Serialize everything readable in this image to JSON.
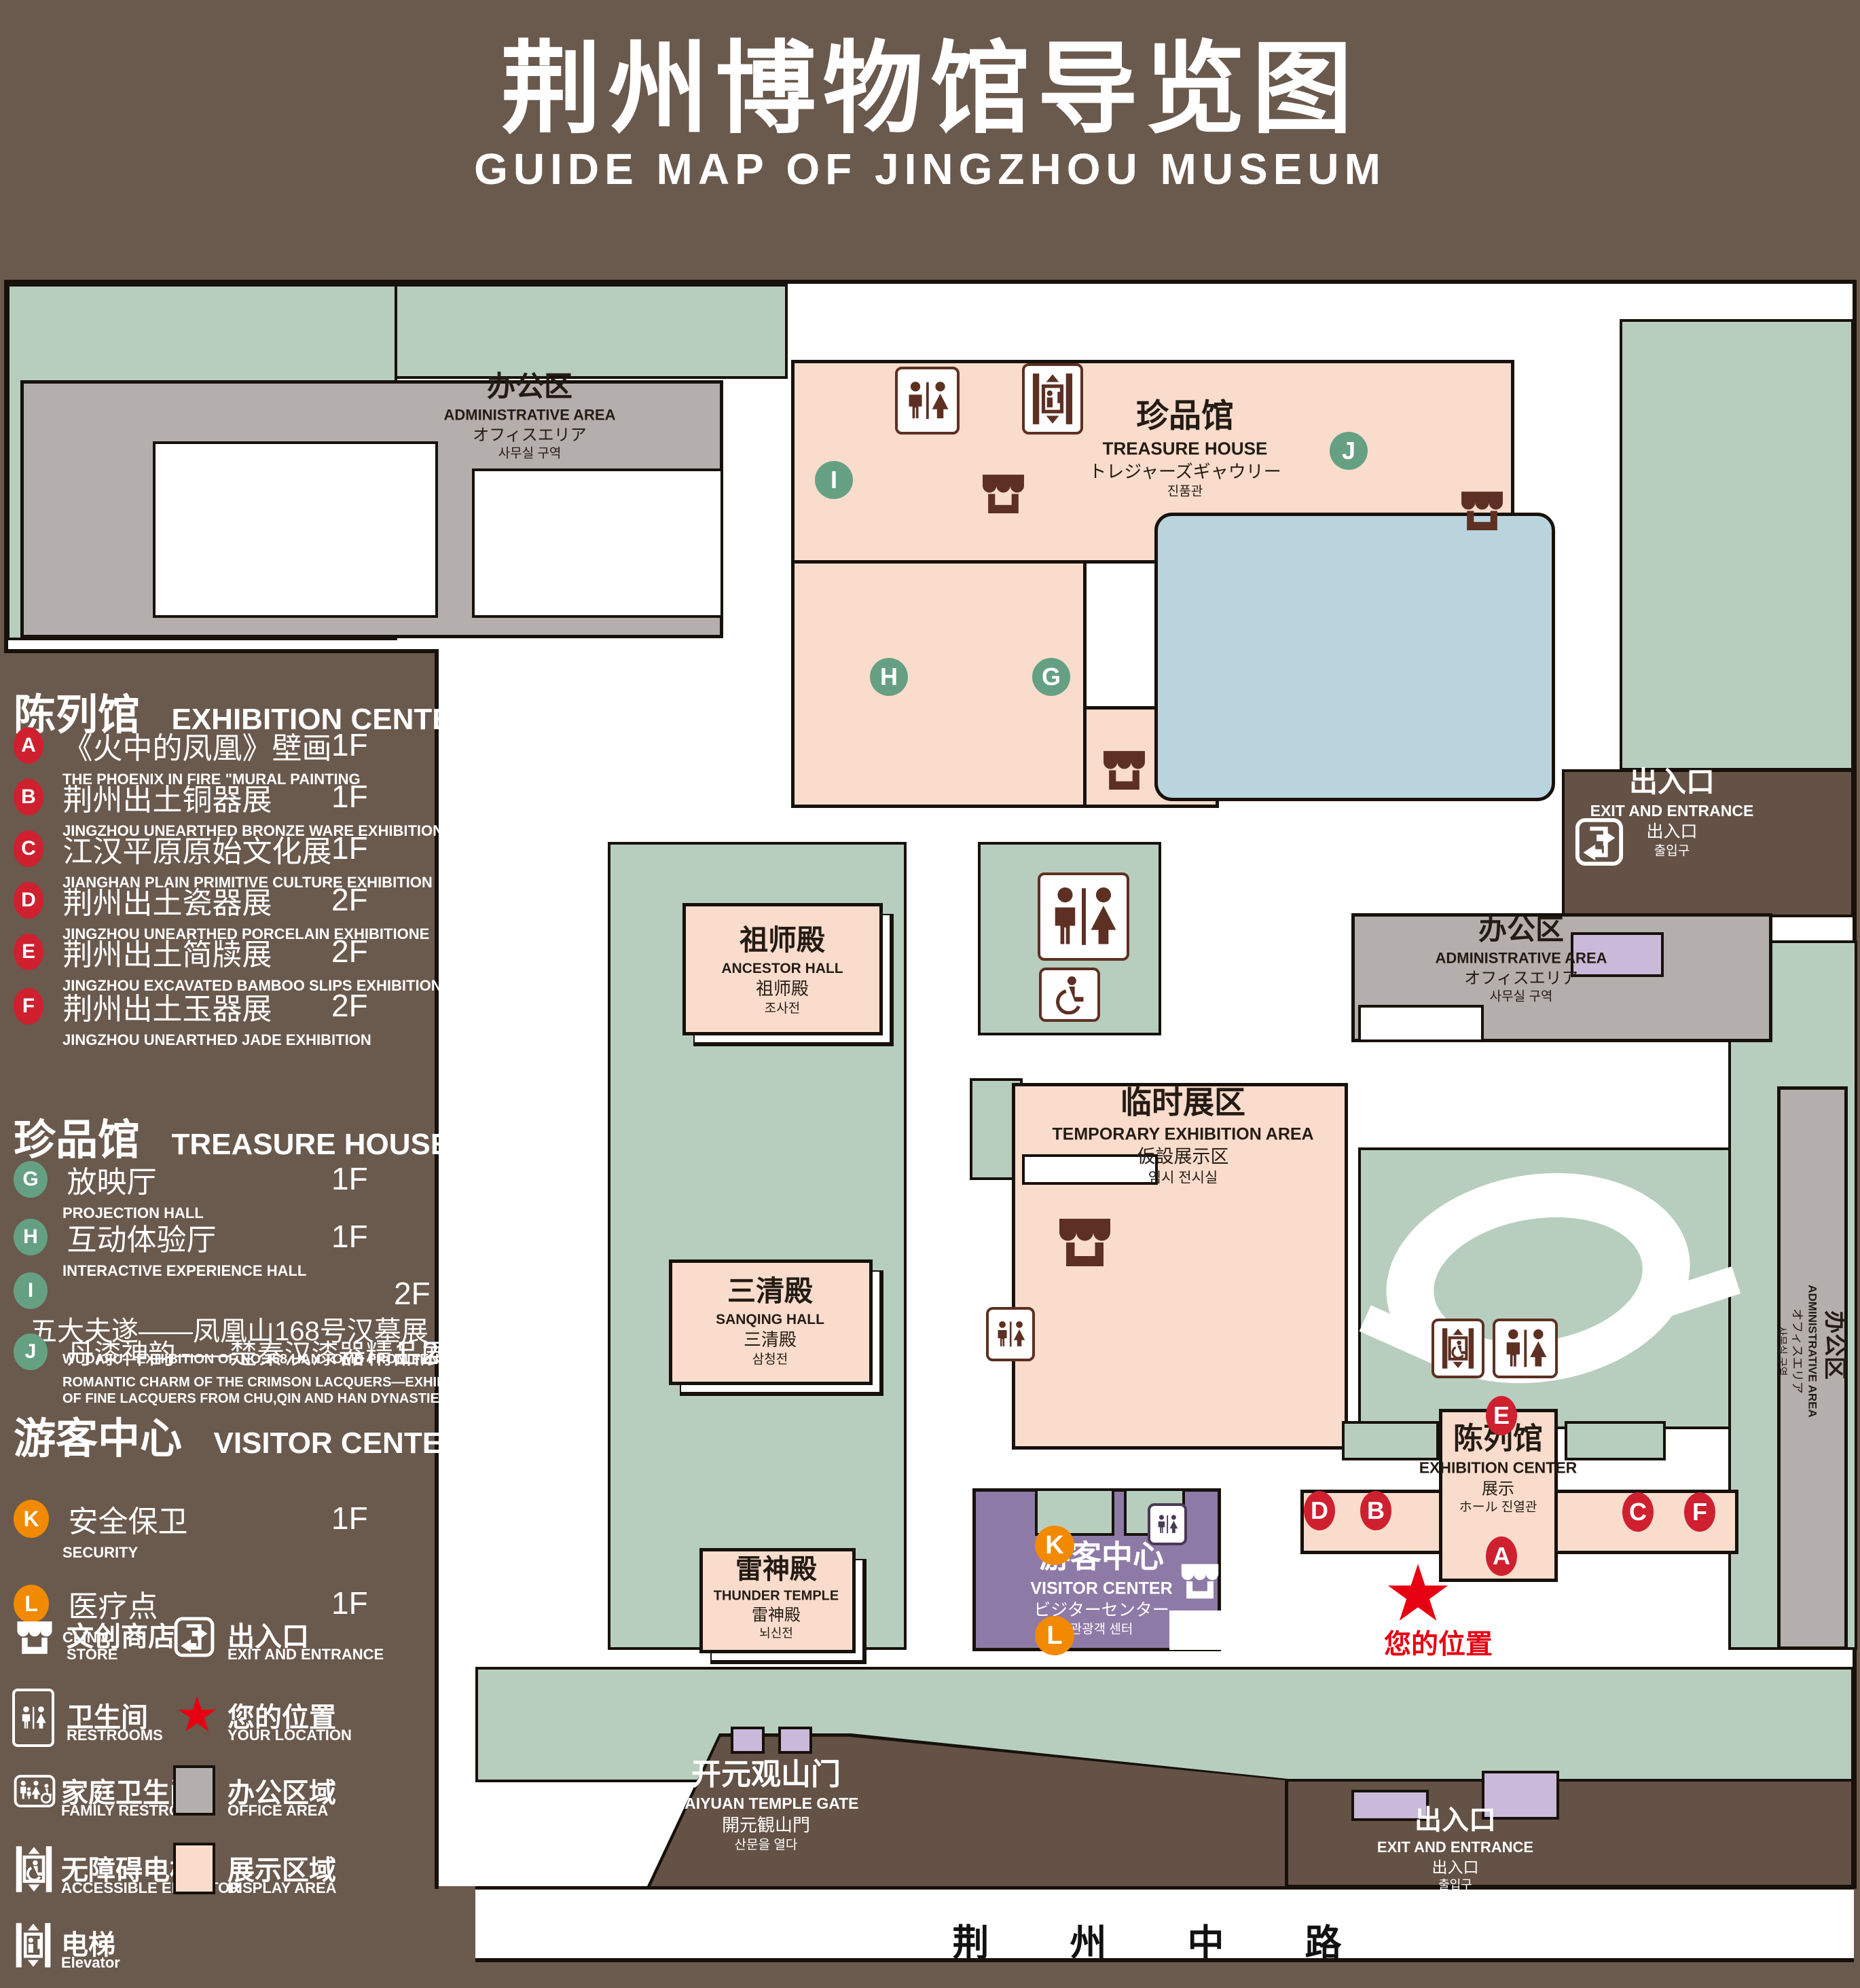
{
  "title": {
    "zh": "荆州博物馆导览图",
    "en": "GUIDE MAP OF JINGZHOU MUSEUM"
  },
  "colors": {
    "background": "#6a594d",
    "map_green": "#b7cebe",
    "display_area": "#f9dccc",
    "office_area": "#b4afac",
    "visitor_center": "#8e7aa7",
    "pond": "#bad4dd",
    "marker_red": "#cf2030",
    "marker_green": "#66a083",
    "marker_orange": "#f18a00",
    "location_red": "#e60012",
    "icon_brown": "#5d3023"
  },
  "legend": {
    "sections": [
      {
        "zh": "陈列馆",
        "en": "EXHIBITION CENTER",
        "items": [
          {
            "letter": "A",
            "zh": "《火中的凤凰》壁画",
            "en": "THE PHOENIX IN FIRE \"MURAL PAINTING",
            "floor": "1F"
          },
          {
            "letter": "B",
            "zh": "荆州出土铜器展",
            "en": "JINGZHOU UNEARTHED BRONZE WARE EXHIBITION",
            "floor": "1F"
          },
          {
            "letter": "C",
            "zh": "江汉平原原始文化展",
            "en": "JIANGHAN PLAIN PRIMITIVE CULTURE EXHIBITION",
            "floor": "1F"
          },
          {
            "letter": "D",
            "zh": "荆州出土瓷器展",
            "en": "JINGZHOU UNEARTHED PORCELAIN EXHIBITIONE",
            "floor": "2F"
          },
          {
            "letter": "E",
            "zh": "荆州出土简牍展",
            "en": "JINGZHOU EXCAVATED BAMBOO SLIPS EXHIBITION",
            "floor": "2F"
          },
          {
            "letter": "F",
            "zh": "荆州出土玉器展",
            "en": "JINGZHOU UNEARTHED JADE EXHIBITION",
            "floor": "2F"
          }
        ]
      },
      {
        "zh": "珍品馆",
        "en": "TREASURE HOUSE",
        "items": [
          {
            "letter": "G",
            "zh": "放映厅",
            "en": "PROJECTION HALL",
            "floor": "1F"
          },
          {
            "letter": "H",
            "zh": "互动体验厅",
            "en": "INTERACTIVE EXPERIENCE HALL",
            "floor": "1F"
          },
          {
            "letter": "I",
            "zh": "五大夫遂——凤凰山168号汉墓展",
            "en": "WUDAFU—EXHIBITION OF NO.168 HAN TOMB FROM FENGHUANGSHAN",
            "floor": "2F"
          },
          {
            "letter": "J",
            "zh": "丹漆神韵——楚秦汉漆器精品展",
            "en": "ROMANTIC CHARM OF THE CRIMSON LACQUERS—EXHIBITIONS",
            "en2": "OF FINE LACQUERS FROM CHU,QIN AND HAN DYNASTIES",
            "floor": "1-2F"
          }
        ]
      },
      {
        "zh": "游客中心",
        "en": "VISITOR CENTER",
        "items": [
          {
            "letter": "K",
            "zh": "安全保卫",
            "en": "SECURITY",
            "floor": "1F"
          },
          {
            "letter": "L",
            "zh": "医疗点",
            "en": "CLINIC",
            "floor": "1F"
          }
        ]
      }
    ],
    "symbols": [
      {
        "icon": "store-icon",
        "zh": "文创商店",
        "en": "STORE"
      },
      {
        "icon": "exit-entrance-icon",
        "zh": "出入口",
        "en": "EXIT AND ENTRANCE"
      },
      {
        "icon": "restrooms-icon",
        "zh": "卫生间",
        "en": "RESTROOMS"
      },
      {
        "icon": "your-location-star",
        "zh": "您的位置",
        "en": "YOUR LOCATION"
      },
      {
        "icon": "family-restrooms-icon",
        "zh": "家庭卫生间",
        "en": "FAMILY RESTROOMS"
      },
      {
        "icon": "office-area-swatch",
        "zh": "办公区域",
        "en": "OFFICE AREA"
      },
      {
        "icon": "accessible-elevator-icon",
        "zh": "无障碍电梯",
        "en": "ACCESSIBLE ELEVATOR"
      },
      {
        "icon": "display-area-swatch",
        "zh": "展示区域",
        "en": "DISPLAY AREA"
      },
      {
        "icon": "elevator-icon",
        "zh": "电梯",
        "en": "Elevator"
      }
    ]
  },
  "map": {
    "buildings": {
      "admin_top_left": {
        "zh": "办公区",
        "en": "ADMINISTRATIVE AREA",
        "jp": "オフィスエリア",
        "kr": "사무실 구역"
      },
      "treasure_house": {
        "zh": "珍品馆",
        "en": "TREASURE HOUSE",
        "jp": "トレジャーズギャウリー",
        "kr": "진품관"
      },
      "ancestor_hall": {
        "zh": "祖师殿",
        "en": "ANCESTOR HALL",
        "zh2": "祖师殿",
        "kr": "조사전"
      },
      "admin_right": {
        "zh": "办公区",
        "en": "ADMINISTRATIVE AREA",
        "jp": "オフィスエリア",
        "kr": "사무실 구역"
      },
      "admin_right_strip": {
        "zh": "办公区",
        "en": "ADMINISTRATIVE AREA",
        "jp": "オフィスエリア",
        "kr": "사무실 구역"
      },
      "temporary_exhibition": {
        "zh": "临时展区",
        "en": "TEMPORARY EXHIBITION AREA",
        "jp": "仮設展示区",
        "kr": "임시 전시실"
      },
      "sanqing_hall": {
        "zh": "三清殿",
        "en": "SANQING HALL",
        "zh2": "三清殿",
        "kr": "삼청전"
      },
      "thunder_temple": {
        "zh": "雷神殿",
        "en": "THUNDER TEMPLE",
        "zh2": "雷神殿",
        "kr": "뇌신전"
      },
      "visitor_center": {
        "zh": "游客中心",
        "en": "VISITOR CENTER",
        "jp": "ビジターセンター",
        "kr": "관광객 센터"
      },
      "exhibition_center": {
        "zh": "陈列馆",
        "en": "EXHIBITION CENTER",
        "jp": "展示",
        "kr": "ホール 진열관"
      },
      "kaiyuan_gate": {
        "zh": "开元观山门",
        "en": "KAIYUAN TEMPLE GATE",
        "jp": "開元観山門",
        "kr": "산문을 열다"
      },
      "exit_right": {
        "zh": "出入口",
        "en": "EXIT AND ENTRANCE",
        "zh2": "出入口",
        "kr": "출입구"
      },
      "exit_bottom": {
        "zh": "出入口",
        "en": "EXIT AND ENTRANCE",
        "zh2": "出入口",
        "kr": "출입구"
      },
      "road": {
        "zh": "荆 州 中 路"
      }
    },
    "your_location": {
      "zh": "您的位置"
    },
    "markers": [
      {
        "letter": "A"
      },
      {
        "letter": "B"
      },
      {
        "letter": "C"
      },
      {
        "letter": "D"
      },
      {
        "letter": "E"
      },
      {
        "letter": "F"
      },
      {
        "letter": "G"
      },
      {
        "letter": "H"
      },
      {
        "letter": "I"
      },
      {
        "letter": "J"
      },
      {
        "letter": "K"
      },
      {
        "letter": "L"
      }
    ]
  }
}
